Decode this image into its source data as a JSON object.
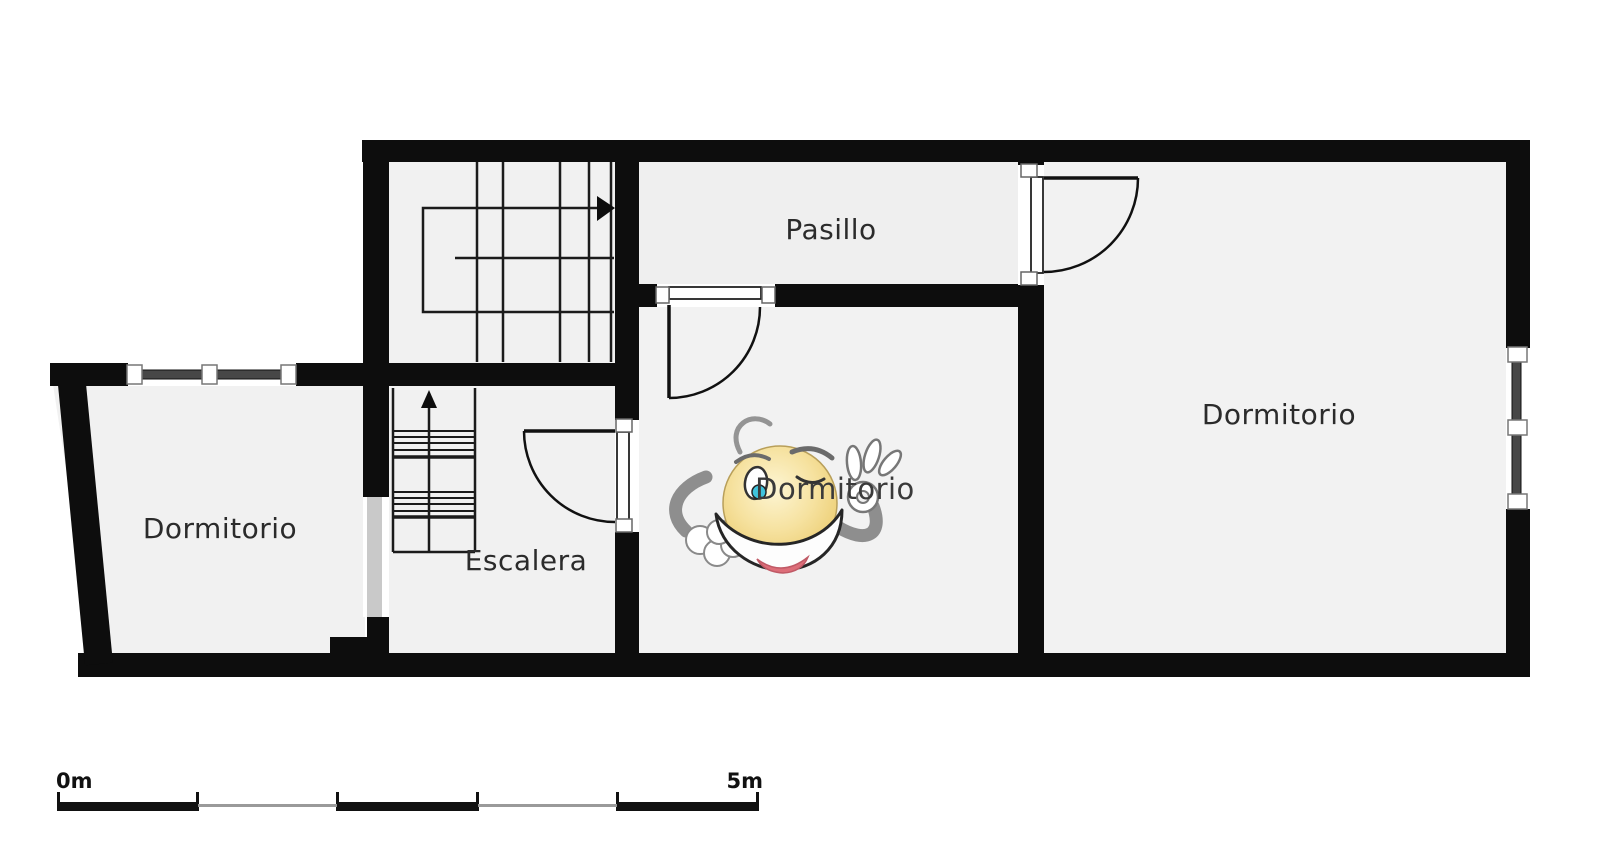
{
  "plan": {
    "type": "floor-plan",
    "rooms": {
      "pasillo": "Pasillo",
      "dormitorio_right": "Dormitorio",
      "dormitorio_center": "Dormitorio",
      "dormitorio_left": "Dormitorio",
      "escalera": "Escalera"
    },
    "colors": {
      "wall": "#0d0d0d",
      "floor": "#f1f1f1",
      "glass": "#474747",
      "passage": "#c9c9c9",
      "walk_line": "#1b1b1b"
    }
  },
  "watermark": {
    "description": "smiley-ok-mascot",
    "colors": {
      "face": "#f6e2a0",
      "face_edge": "#eccd72",
      "arm": "#8e8e8e",
      "glove": "#ffffff",
      "tongue": "#dd6e79",
      "eye_iris": "#3fc3dc"
    }
  },
  "scale_bar": {
    "start": "0m",
    "end": "5m",
    "segments": 5
  }
}
